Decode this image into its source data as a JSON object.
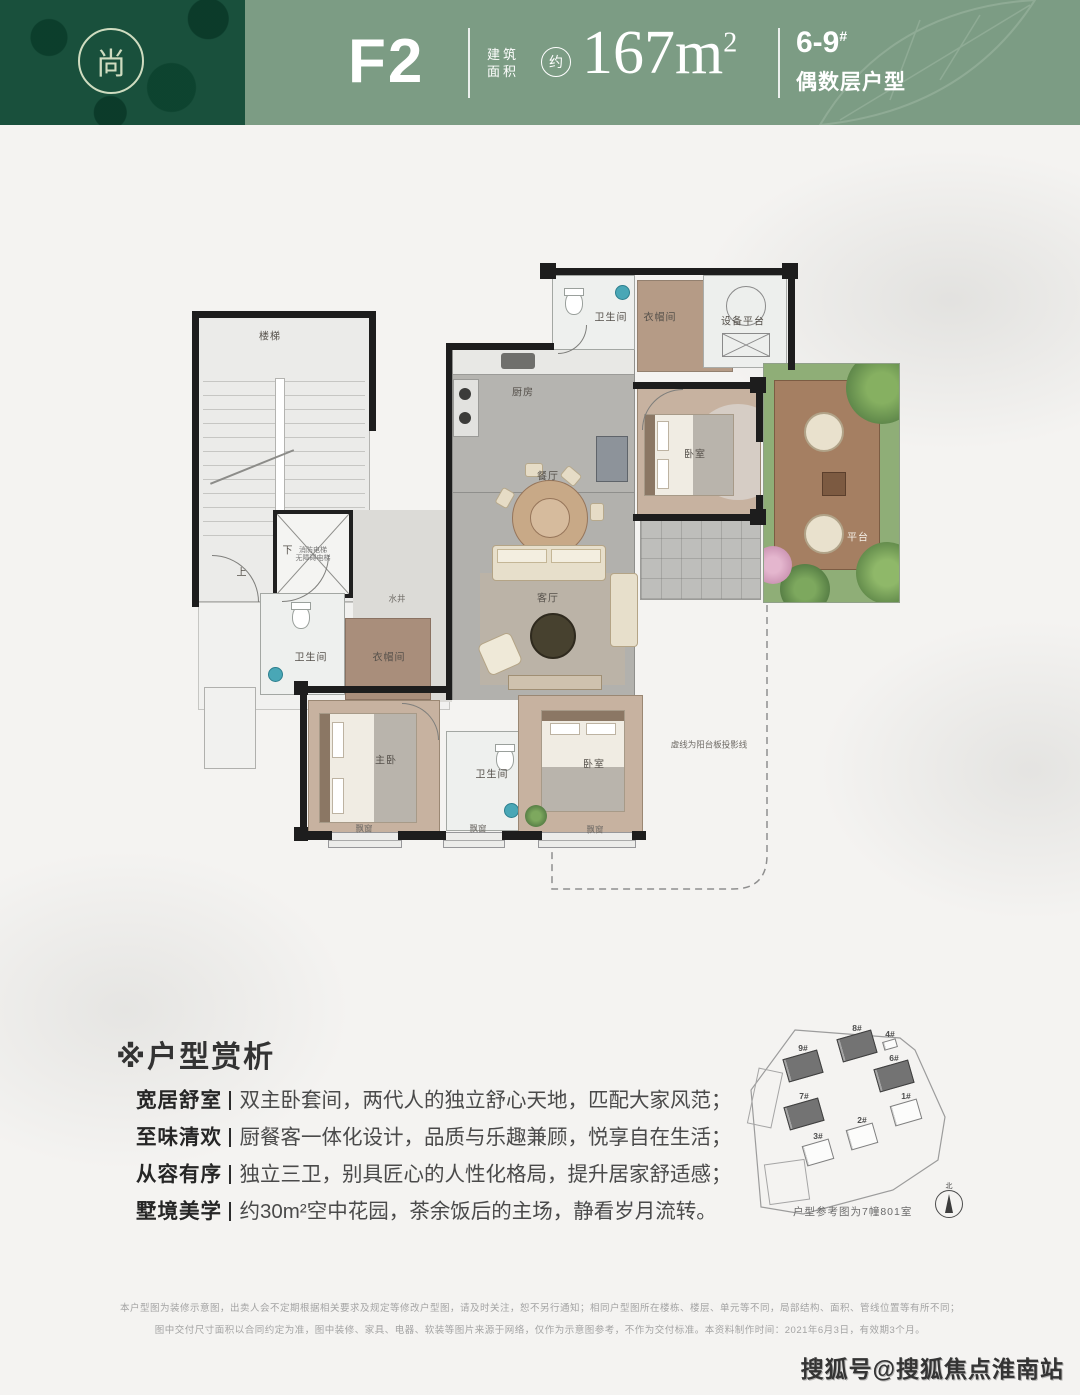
{
  "header": {
    "logo_char": "尚",
    "model": "F2",
    "area_label": "建筑\n面积",
    "approx": "约",
    "area_value": "167m",
    "area_sup": "2",
    "range": "6-9",
    "range_sup": "#",
    "range_sub": "偶数层户型"
  },
  "floorplan": {
    "labels": [
      {
        "name": "stairs",
        "text": "楼梯",
        "x": 80,
        "y": 82
      },
      {
        "name": "stairs-up",
        "text": "上",
        "x": 52,
        "y": 318
      },
      {
        "name": "stairs-down",
        "text": "下",
        "x": 98,
        "y": 296
      },
      {
        "name": "elevator",
        "text": "消防电梯\n无障碍电梯",
        "x": 123,
        "y": 300,
        "cls": "micro"
      },
      {
        "name": "water-well",
        "text": "水井",
        "x": 207,
        "y": 344,
        "cls": "tiny"
      },
      {
        "name": "kitchen",
        "text": "厨房",
        "x": 333,
        "y": 138
      },
      {
        "name": "dining-room",
        "text": "餐厅",
        "x": 358,
        "y": 222
      },
      {
        "name": "living-room",
        "text": "客厅",
        "x": 358,
        "y": 344
      },
      {
        "name": "bath-north",
        "text": "卫生间",
        "x": 421,
        "y": 63
      },
      {
        "name": "cloak-north",
        "text": "衣帽间",
        "x": 470,
        "y": 63
      },
      {
        "name": "equipment-platform",
        "text": "设备平台",
        "x": 553,
        "y": 67
      },
      {
        "name": "bedroom-north",
        "text": "卧室",
        "x": 505,
        "y": 200
      },
      {
        "name": "terrace",
        "text": "平台",
        "x": 668,
        "y": 283,
        "cls": "light"
      },
      {
        "name": "bath-west",
        "text": "卫生间",
        "x": 121,
        "y": 403
      },
      {
        "name": "cloak-master",
        "text": "衣帽间",
        "x": 199,
        "y": 403
      },
      {
        "name": "master-bedroom",
        "text": "主卧",
        "x": 196,
        "y": 506
      },
      {
        "name": "bath-south",
        "text": "卫生间",
        "x": 302,
        "y": 520
      },
      {
        "name": "bedroom-south",
        "text": "卧室",
        "x": 404,
        "y": 510
      },
      {
        "name": "bay-window-master",
        "text": "飘窗",
        "x": 174,
        "y": 574,
        "cls": "tiny"
      },
      {
        "name": "bay-window-mid",
        "text": "飘窗",
        "x": 288,
        "y": 574,
        "cls": "tiny"
      },
      {
        "name": "bay-window-south",
        "text": "飘窗",
        "x": 405,
        "y": 575,
        "cls": "tiny"
      },
      {
        "name": "projection-note",
        "text": "虚线为阳台板投影线",
        "x": 519,
        "y": 490,
        "cls": "tiny"
      }
    ]
  },
  "analysis": {
    "title_mark": "※",
    "title_text": "户型赏析",
    "items": [
      {
        "tag": "宽居舒室",
        "text": "双主卧套间，两代人的独立舒心天地，匹配大家风范；"
      },
      {
        "tag": "至味清欢",
        "text": "厨餐客一体化设计，品质与乐趣兼顾，悦享自在生活；"
      },
      {
        "tag": "从容有序",
        "text": "独立三卫，别具匠心的人性化格局，提升居家舒适感；"
      },
      {
        "tag": "墅境美学",
        "text": "约30m²空中花园，茶余饭后的主场，静看岁月流转。"
      }
    ]
  },
  "siteplan": {
    "caption": "户型参考图为7幢801室",
    "compass_label": "北",
    "buildings": [
      {
        "label": "9#",
        "x": 40,
        "y": 32,
        "w": 36,
        "h": 24,
        "rot": -16,
        "filled": true
      },
      {
        "label": "8#",
        "x": 94,
        "y": 12,
        "w": 36,
        "h": 24,
        "rot": -16,
        "filled": true
      },
      {
        "label": "4#",
        "x": 138,
        "y": 18,
        "w": 14,
        "h": 9,
        "rot": -16,
        "filled": false
      },
      {
        "label": "6#",
        "x": 131,
        "y": 42,
        "w": 36,
        "h": 24,
        "rot": -16,
        "filled": true
      },
      {
        "label": "7#",
        "x": 41,
        "y": 80,
        "w": 36,
        "h": 24,
        "rot": -16,
        "filled": true
      },
      {
        "label": "1#",
        "x": 147,
        "y": 80,
        "w": 28,
        "h": 21,
        "rot": -16,
        "filled": false
      },
      {
        "label": "2#",
        "x": 103,
        "y": 104,
        "w": 28,
        "h": 21,
        "rot": -16,
        "filled": false
      },
      {
        "label": "3#",
        "x": 59,
        "y": 120,
        "w": 28,
        "h": 21,
        "rot": -16,
        "filled": false
      }
    ]
  },
  "disclaimer": {
    "line1": "本户型图为装修示意图，出卖人会不定期根据相关要求及规定等修改户型图，请及时关注，恕不另行通知；相同户型图所在楼栋、楼层、单元等不同，局部结构、面积、管线位置等有所不同；",
    "line2": "图中交付尺寸面积以合同约定为准，图中装修、家具、电器、软装等图片来源于网络，仅作为示意图参考，不作为交付标准。本资料制作时间：2021年6月3日，有效期3个月。"
  },
  "watermark": "搜狐号@搜狐焦点淮南站"
}
